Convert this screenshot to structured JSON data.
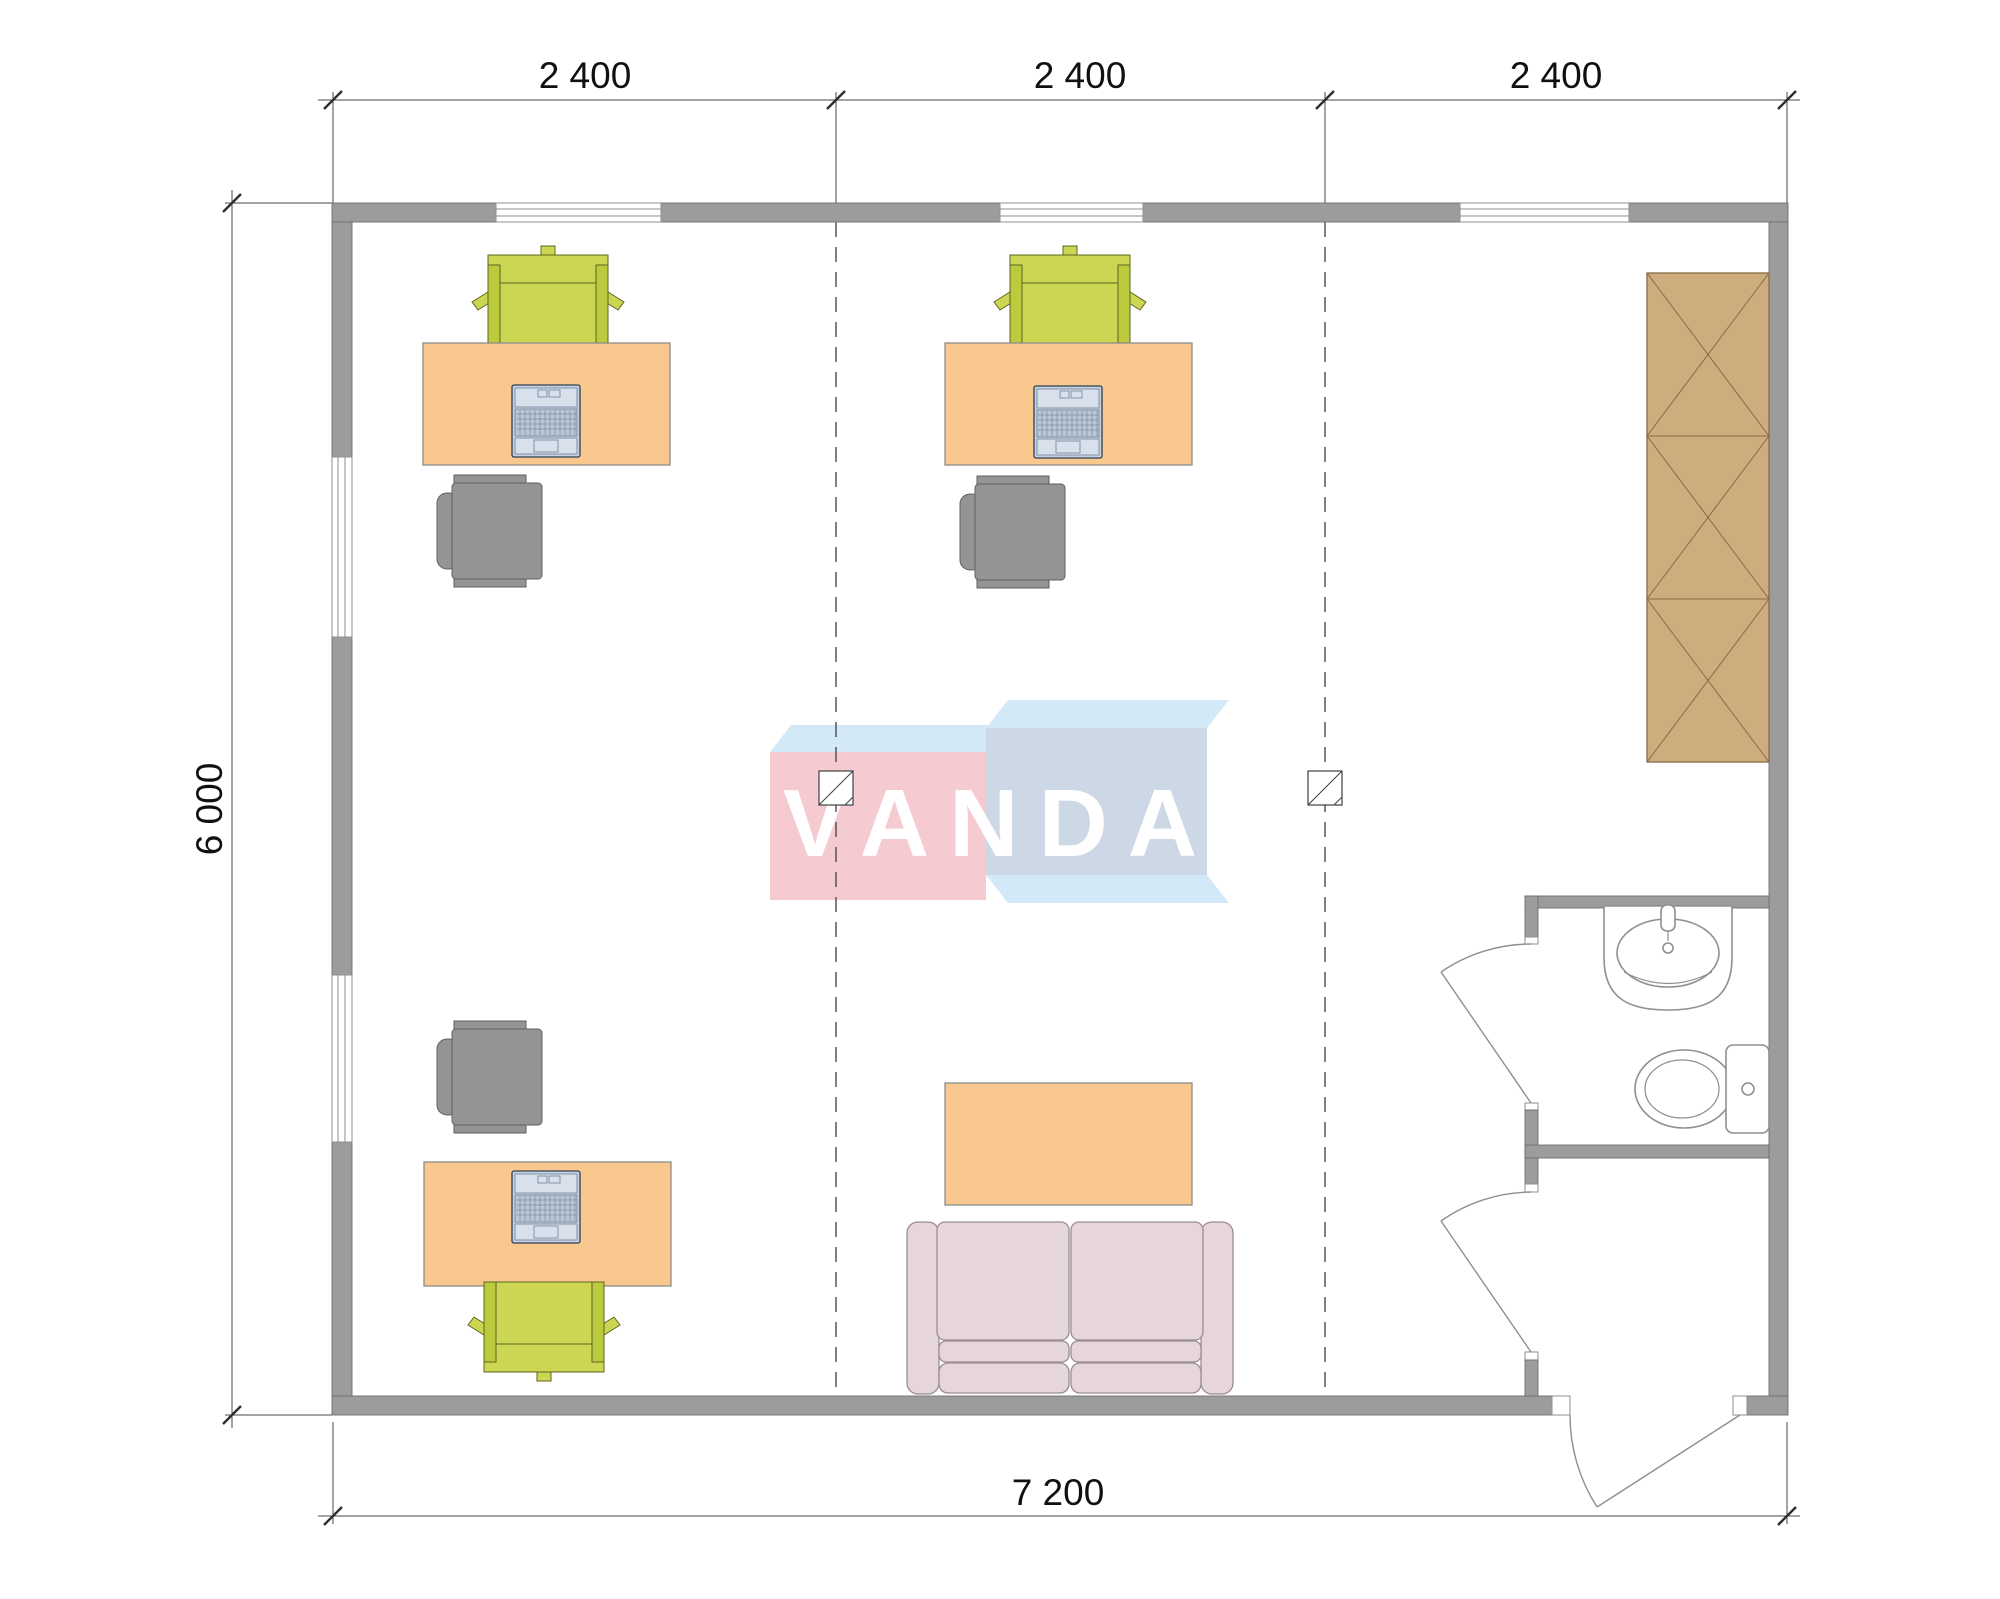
{
  "drawing": {
    "brand": {
      "logo_text": "VANDA"
    },
    "dimensions": {
      "top": [
        "2 400",
        "2 400",
        "2 400"
      ],
      "left": "6 000",
      "bottom": "7 200"
    },
    "contents": {
      "workstations": 3,
      "items": [
        "desk",
        "laptop",
        "task-chair",
        "visitor-chair",
        "sofa",
        "coffee-table",
        "wardrobe",
        "wash-basin",
        "toilet"
      ],
      "doors": [
        "bathroom-door",
        "vestibule-door",
        "entrance-door"
      ],
      "windows": {
        "top_wall": 3,
        "left_wall": 2
      }
    }
  },
  "colors": {
    "wall": "#9c9c9c",
    "wall-edge": "#6f6f6f",
    "line": "#4a4a4a",
    "door": "#8f8f8f",
    "win-edge": "#8f8f8f",
    "desk": "#f9c88e",
    "desk-edge": "#8c8c8c",
    "chair-green": "#ccd652",
    "chair-green-dark": "#bcca3e",
    "chair-green-edge": "#5d6620",
    "chair-gray": "#949494",
    "chair-gray-edge": "#5f5f5f",
    "laptop": "#c6d2e3",
    "laptop-edge": "#2e3e52",
    "sofa": "#e6d6d9",
    "sofa-edge": "#9a8c90",
    "wardrobe": "#cdac7e",
    "wardrobe-edge": "#876b47",
    "fixture": "#8f8f8f",
    "logo-pink": "#f6cad1",
    "logo-blue": "#ccd8e5",
    "logo-top": "#d3e9f7",
    "logo-text": "#ffffff"
  }
}
